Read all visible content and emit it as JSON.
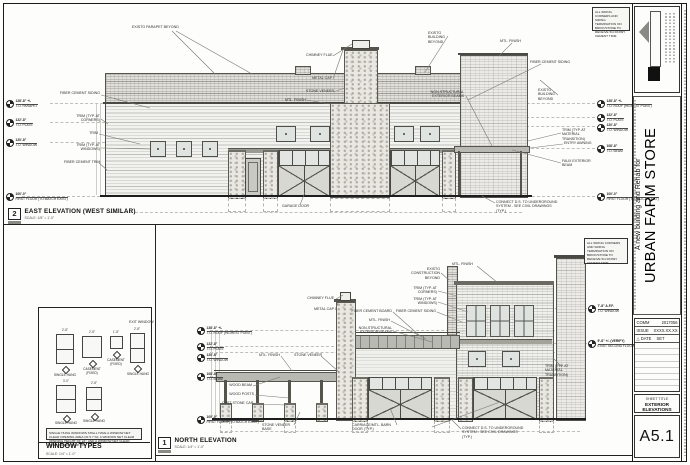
{
  "sheet": {
    "number": "A5.1",
    "sheet_title_label": "SHEET TITLE",
    "title": "EXTERIOR ELEVATIONS",
    "project_prefix": "A new building and Rehab for",
    "project_name": "URBAN FARM STORE",
    "comm_label": "COMM",
    "comm_value": "2017056",
    "issue_label": "ISSUE",
    "issue_value": "XXXX.XX.XX",
    "date_label": "△ DATE",
    "date_value": "SET"
  },
  "notes": {
    "siding_note": "ALL SIDING CORNERS AND SIDING TERMINATION ON BRICK/STONE TO RECEIVE 5/4 FINISH CEMENT TRIM."
  },
  "east": {
    "bubble": "2",
    "title": "EAST ELEVATION (WEST SIMILAR)",
    "scale": "SCALE: 1/8\" = 1'-0\"",
    "levels_left": [
      {
        "elev": "128'-8\" +/-",
        "name": "T.O. PARAPET"
      },
      {
        "elev": "122'-8\"",
        "name": "T.O. PLATE"
      },
      {
        "elev": "120'-8\"",
        "name": "T.O. WINDOW"
      },
      {
        "elev": "100'-0\"",
        "name": "FIRST FLOOR (TO MATCH EXIST)"
      }
    ],
    "levels_right": [
      {
        "elev": "128'-8\" +/-",
        "name": "T.O. ROOF (HIGHEST POINT)"
      },
      {
        "elev": "122'-8\"",
        "name": "T.O. PLATE"
      },
      {
        "elev": "120'-8\"",
        "name": "T.O. WINDOW"
      },
      {
        "elev": "108'-8\"",
        "name": "T.O. BEAM"
      },
      {
        "elev": "100'-0\"",
        "name": "FIRST FLOOR (TO MATCH EXIST)"
      }
    ],
    "callouts": {
      "fcs": "FIBER CEMENT SIDING",
      "trim_c": "TRIM (TYP. AT CORNERS)",
      "trim": "TRIM",
      "trim_w": "TRIM (TYP. AT WINDOWS)",
      "fct": "FIBER CEMENT TRIM",
      "parapet_beyond": "EXISTG PARAPET BEYOND",
      "chimney_flue": "CHIMNEY FLUE",
      "metal_cap": "METAL CAP",
      "stone_veneer": "STONE VENEER",
      "mtl_finish": "MTL. FINISH",
      "bldg_beyond": "EXISTG BUILDING BEYOND",
      "nonstruct": "NON-STRUCTURAL EXTERIOR BEAMS",
      "mtl_finish_r": "MTL. FINISH",
      "fcs_r": "FIBER CEMENT SIDING",
      "bldg_beyond_r": "EXISTG BUILDING BEYOND",
      "trim_trans": "TRIM (TYP. AT MATERIAL TRANSITION)",
      "entry_awning": "ENTRY AWNING",
      "faux_beam": "FAUX EXTERIOR BEAM",
      "garage_door": "GARAGE DOOR",
      "connect_ds": "CONNECT D.S. TO UNDERGROUND SYSTEM - SEE CIVIL DRAWINGS (TYP.)"
    }
  },
  "north": {
    "bubble": "1",
    "title": "NORTH ELEVATION",
    "scale": "SCALE: 1/4\" = 1'-0\"",
    "levels_left": [
      {
        "elev": "128'-8\" +/-",
        "name": "T.O. ROOF (HIGHEST POINT)"
      },
      {
        "elev": "122'-8\"",
        "name": "T.O. PLATE"
      },
      {
        "elev": "120'-8\"",
        "name": "T.O. WINDOW"
      },
      {
        "elev": "108'-8\"",
        "name": "T.O. BEAM"
      },
      {
        "elev": "100'-0\"",
        "name": "FIRST FLOOR (TO MATCH EXIST)"
      }
    ],
    "levels_right": [
      {
        "elev": "7'-8\" A.F.F.",
        "name": "T.O. WINDOW"
      },
      {
        "elev": "9'-8\" +/- (VERIFY)",
        "name": "EXIST SECOND FLOOR"
      }
    ],
    "callouts": {
      "chimney_flue": "CHIMNEY FLUE",
      "metal_cap": "METAL CAP",
      "mtl_finish": "MTL. FINISH",
      "stone_veneer": "STONE VENEER",
      "wood_beam": "WOOD BEAM",
      "wood_posts": "WOOD POSTS",
      "cast_stone_cap": "CAST STONE CAP",
      "stone_base": "STONE VENEER BASE",
      "fc_board": "FIBER CEMENT BOARD",
      "mtl_finish2": "MTL. FINISH",
      "nonstruct": "NON-STRUCTURAL EXTERIOR BEAMS",
      "existg_constr": "EXISTG CONSTRUCTION BEYOND",
      "mtl_finish_top": "MTL. FINISH",
      "trim_c": "TRIM (TYP. AT CORNERS)",
      "trim_w": "TRIM (TYP. AT WINDOWS)",
      "fcs": "FIBER CEMENT SIDING",
      "trim_trans": "TRIM (TYP. AT MATERIAL TRANSITION)",
      "carriage": "CARRIAGE/MTL. BARN DOOR (TYP.)",
      "connect_ds": "CONNECT D.S. TO UNDERGROUND SYSTEM - SEE CIVIL DRAWINGS (TYP.)"
    }
  },
  "windows": {
    "title": "WINDOW TYPES",
    "scale": "SCALE: 1/4\" = 1'-0\"",
    "exit_note": "EXIT WINDOW",
    "note": "SINGLE HUNG WINDOWS SHALL HAVE A WINDOW NET CLEAR OPENING AREA OF 5.7 SF, A WINDOW NET CLEAR OPENING HEIGHT OF 24\", AND A WINDOW NET CLEAR OPENING WIDTH OF 20\".",
    "items": [
      {
        "label": "SINGLE HUNG",
        "dim": "2'-8\""
      },
      {
        "label": "CASEMENT (FIXED)",
        "dim": "2'-8\""
      },
      {
        "label": "CASEMENT (FIXED)",
        "dim": "1'-8\""
      },
      {
        "label": "SINGLE HUNG",
        "dim": "2'-8\""
      },
      {
        "label": "SINGLE HUNG",
        "dim": "3'-0\""
      },
      {
        "label": "SINGLE HUNG",
        "dim": "2'-8\""
      }
    ]
  }
}
